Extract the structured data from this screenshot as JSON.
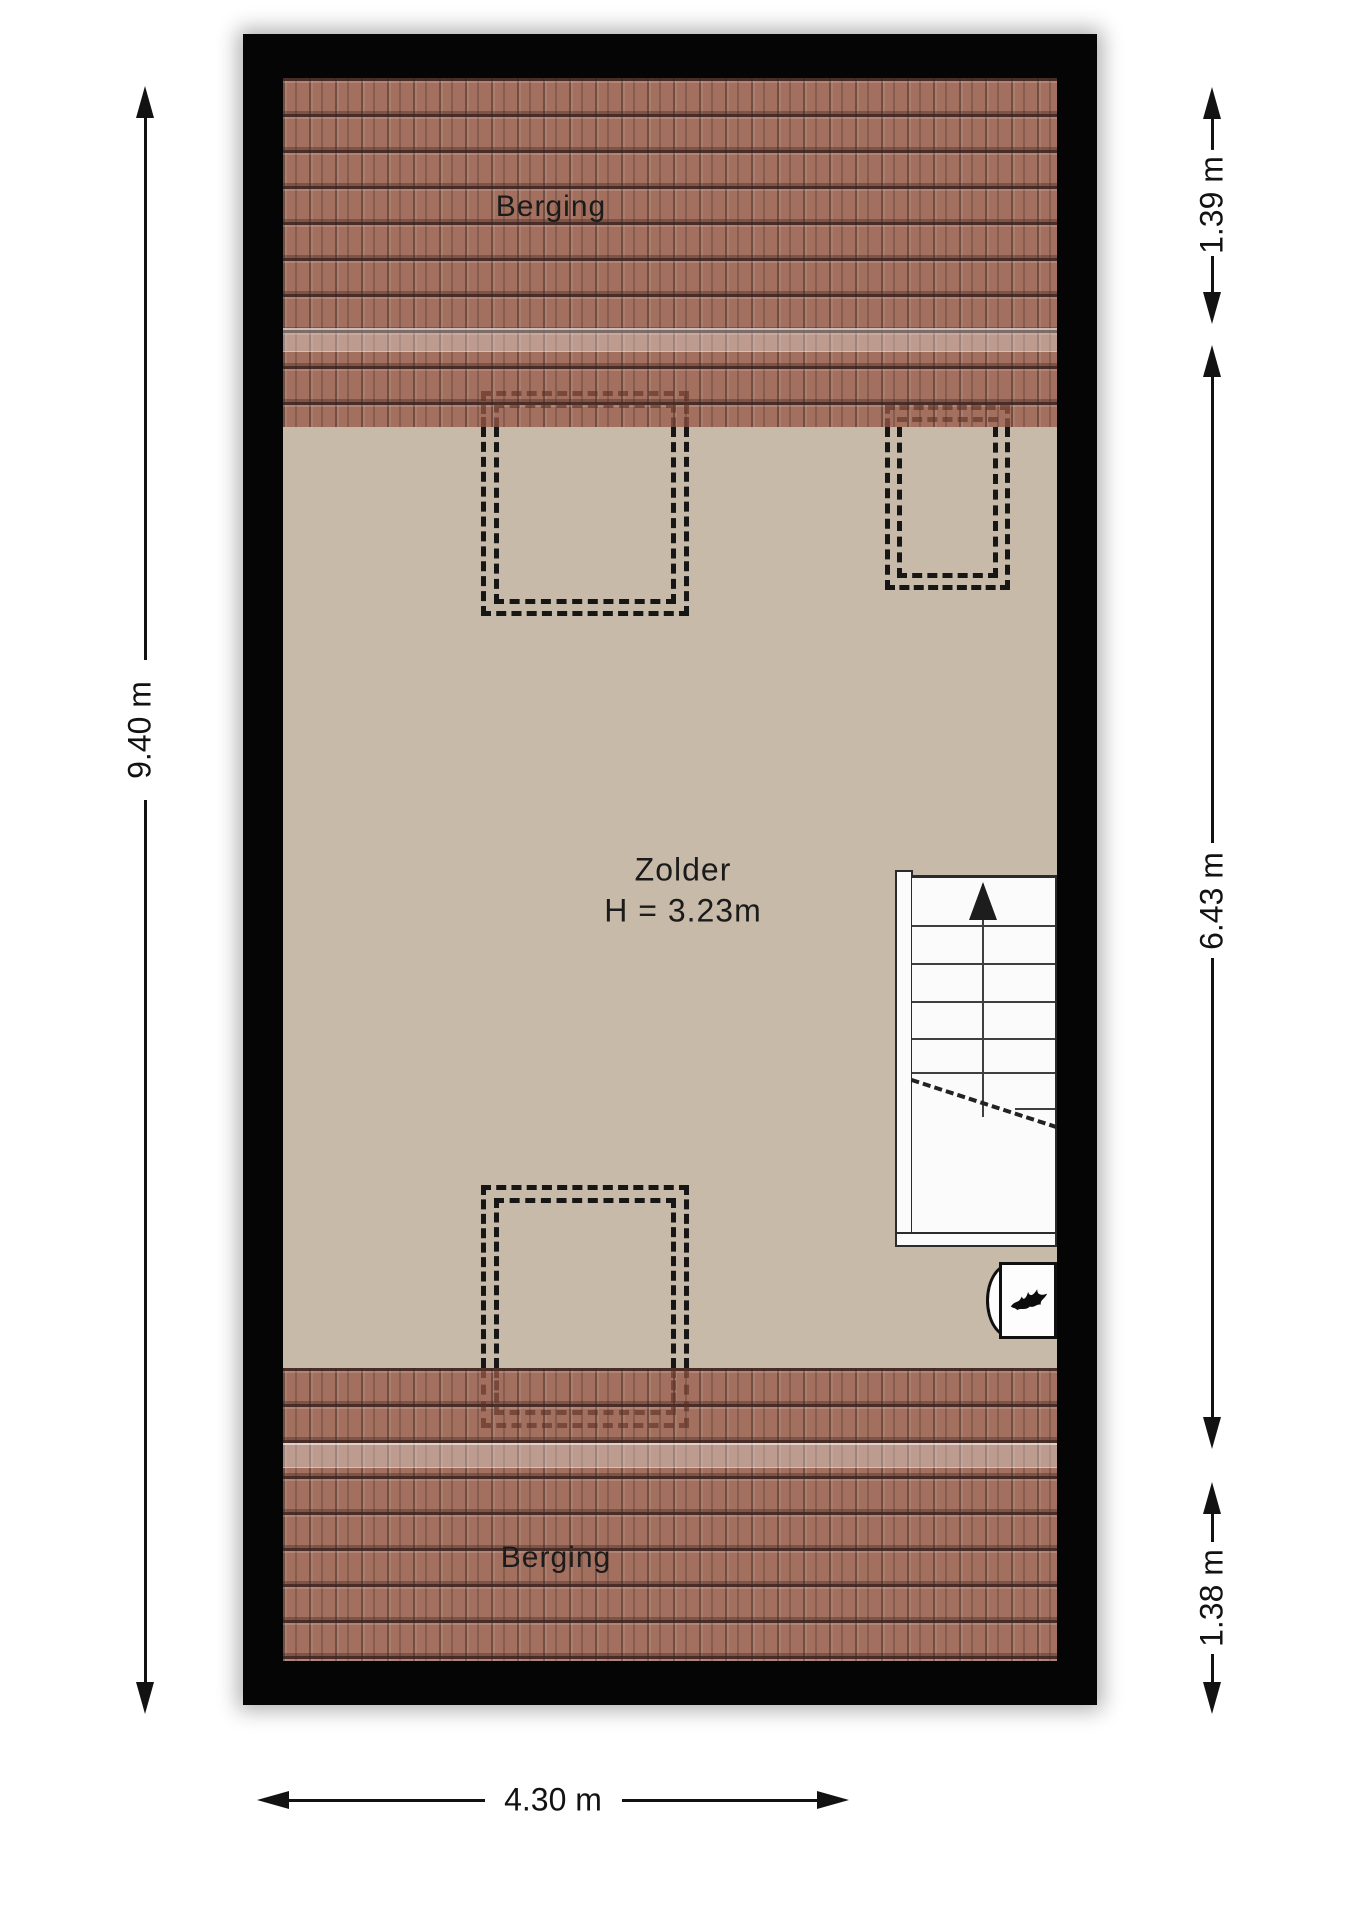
{
  "rooms": [
    {
      "id": "berging-top",
      "label": "Berging"
    },
    {
      "id": "zolder",
      "label": "Zolder",
      "height_label": "H = 3.23m"
    },
    {
      "id": "berging-bottom",
      "label": "Berging"
    }
  ],
  "dimensions": {
    "left": "9.40 m",
    "right_top": "1.39 m",
    "right_middle": "6.43 m",
    "right_bottom": "1.38 m",
    "bottom": "4.30 m"
  },
  "icons": [
    {
      "name": "stair-up-arrow-icon",
      "meaning": "stair direction up"
    },
    {
      "name": "flame-icon",
      "meaning": "boiler / heater"
    }
  ],
  "colors": {
    "wall": "#050505",
    "floor": "#c7baa9",
    "roof_tiles": "#a3705f",
    "roof_highlight_band": "rgba(255,255,255,0.30)",
    "stairs": "#fbfbfb",
    "dash_outline": "#161616"
  }
}
